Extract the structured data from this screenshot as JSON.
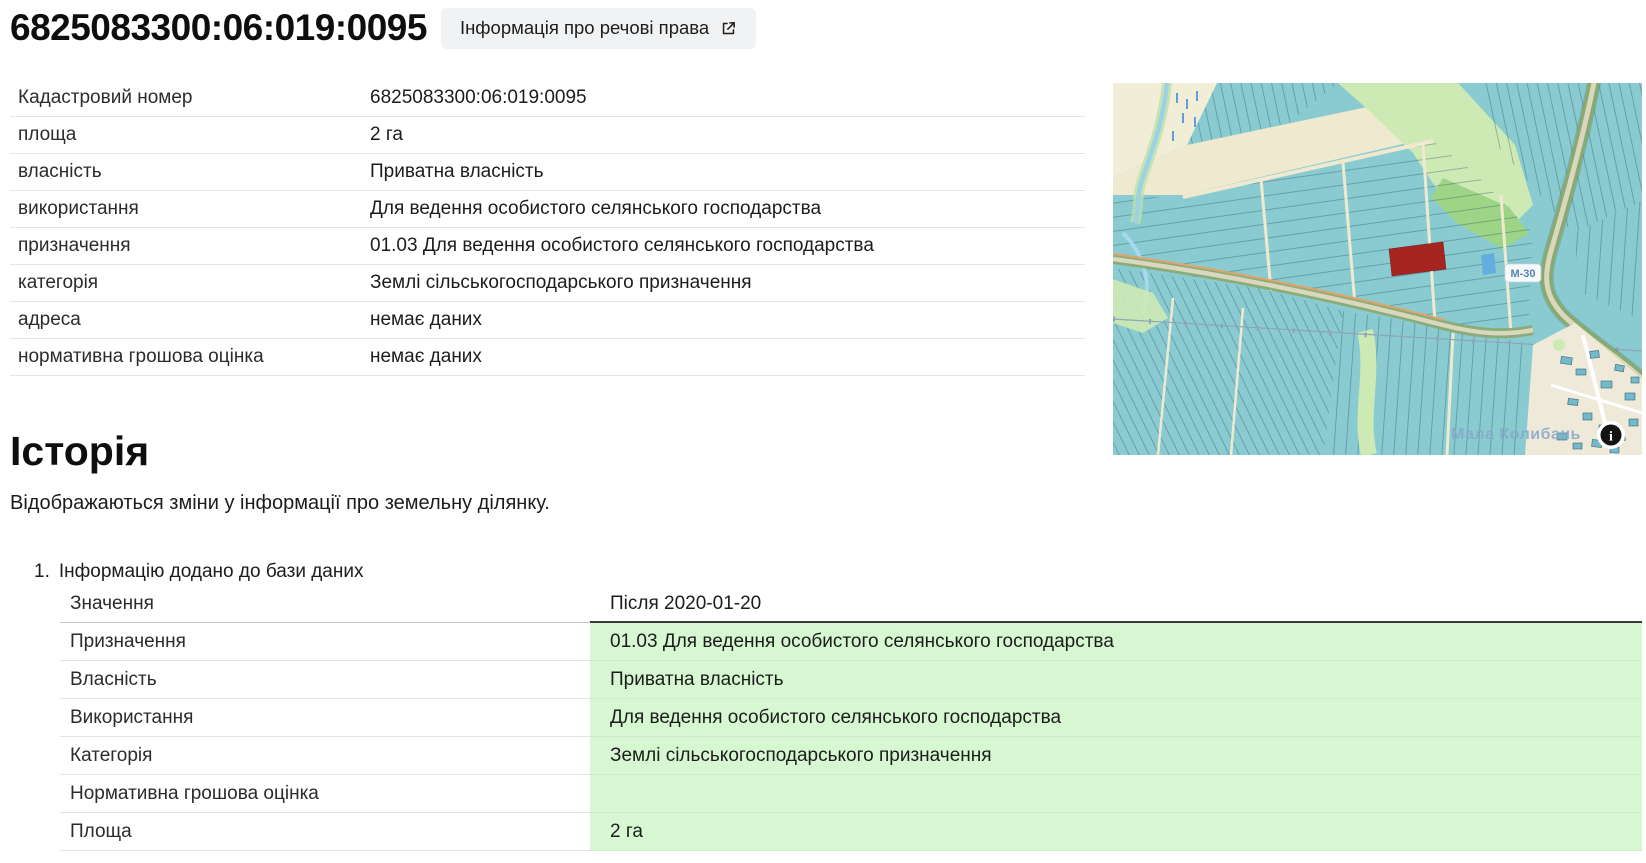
{
  "header": {
    "title": "6825083300:06:019:0095",
    "rights_button_label": "Інформація про речові права"
  },
  "parcel": {
    "rows": [
      {
        "label": "Кадастровий номер",
        "value": "6825083300:06:019:0095"
      },
      {
        "label": "площа",
        "value": "2 га"
      },
      {
        "label": "власність",
        "value": "Приватна власність"
      },
      {
        "label": "використання",
        "value": "Для ведення особистого селянського господарства"
      },
      {
        "label": "призначення",
        "value": "01.03 Для ведення особистого селянського господарства"
      },
      {
        "label": "категорія",
        "value": "Землі сільськогосподарського призначення"
      },
      {
        "label": "адреса",
        "value": "немає даних"
      },
      {
        "label": "нормативна грошова оцінка",
        "value": "немає даних"
      }
    ]
  },
  "map": {
    "road_label": "М-30",
    "place_label": "Мала Колибань",
    "info_glyph": "i",
    "colors": {
      "parcel_fill": "#8acbd1",
      "parcel_line": "#2e5f6e",
      "highlight_parcel": "#a62521",
      "open_land": "#f1edd6",
      "greenery": "#cdeab5",
      "water": "#71b4dd"
    }
  },
  "history": {
    "heading": "Історія",
    "description": "Відображаються зміни у інформації про земельну ділянку.",
    "item": {
      "number": "1.",
      "title": "Інформацію додано до бази даних",
      "header": {
        "label": "Значення",
        "value": "Після 2020-01-20"
      },
      "rows": [
        {
          "label": "Призначення",
          "value": "01.03 Для ведення особистого селянського господарства"
        },
        {
          "label": "Власність",
          "value": "Приватна власність"
        },
        {
          "label": "Використання",
          "value": "Для ведення особистого селянського господарства"
        },
        {
          "label": "Категорія",
          "value": "Землі сільськогосподарського призначення"
        },
        {
          "label": "Нормативна грошова оцінка",
          "value": ""
        },
        {
          "label": "Площа",
          "value": "2 га"
        }
      ]
    }
  }
}
